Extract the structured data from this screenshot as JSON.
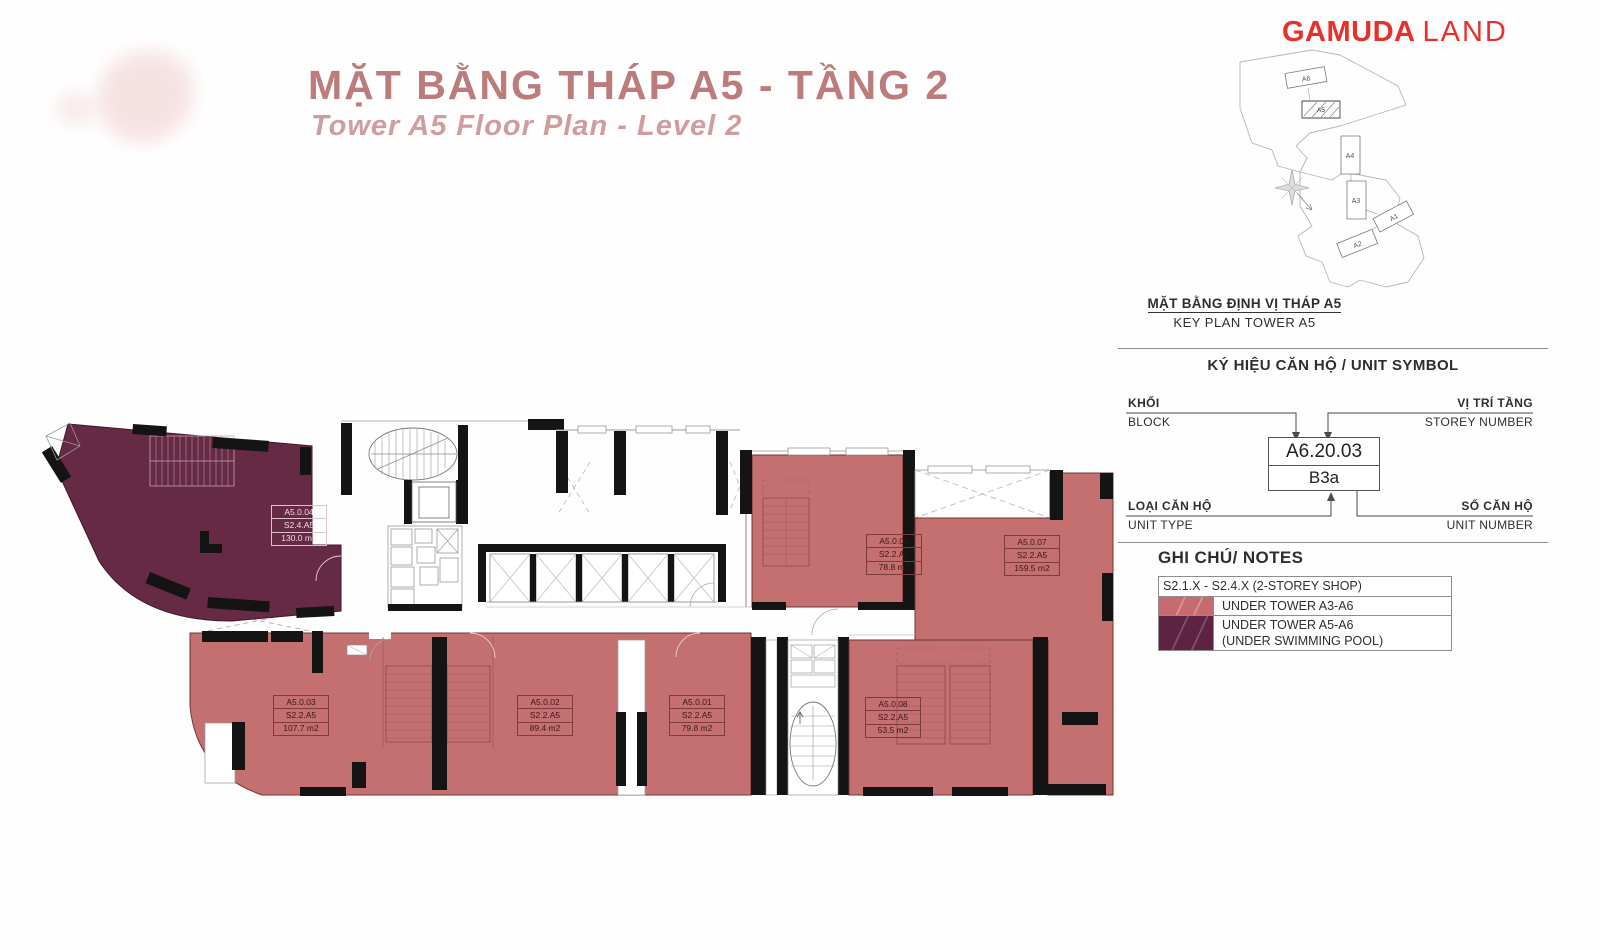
{
  "header": {
    "title_vi": "MẶT BẰNG THÁP A5 - TẦNG 2",
    "title_en": "Tower A5 Floor Plan - Level 2"
  },
  "logo": {
    "brand_bold": "GAMUDA",
    "brand_light": "LAND"
  },
  "keyplan": {
    "title_vi": "MẶT BẰNG ĐỊNH VỊ THÁP A5",
    "title_en": "KEY PLAN TOWER A5",
    "buildings": [
      "A6",
      "A5",
      "A4",
      "A3",
      "A1",
      "A2"
    ]
  },
  "unit_symbol": {
    "section_title": "KÝ HIỆU CĂN HỘ / UNIT SYMBOL",
    "block_vi": "KHỐI",
    "block_en": "BLOCK",
    "storey_vi": "VỊ TRÍ TẦNG",
    "storey_en": "STOREY NUMBER",
    "unit_type_vi": "LOẠI CĂN HỘ",
    "unit_type_en": "UNIT TYPE",
    "unit_number_vi": "SỐ CĂN HỘ",
    "unit_number_en": "UNIT NUMBER",
    "sample_code": "A6.20.03",
    "sample_type": "B3a"
  },
  "notes": {
    "title": "GHI CHÚ/ NOTES",
    "header_row": "S2.1.X - S2.4.X (2-STOREY SHOP)",
    "row_a3a6": "UNDER TOWER A3-A6",
    "row_a5a6_line1": "UNDER TOWER A5-A6",
    "row_a5a6_line2": "(UNDER SWIMMING POOL)"
  },
  "units": {
    "u04": {
      "id": "A5.0.04",
      "type": "S2.4.A5",
      "area": "130.0 m2"
    },
    "u03": {
      "id": "A5.0.03",
      "type": "S2.2.A5",
      "area": "107.7 m2"
    },
    "u02": {
      "id": "A5.0.02",
      "type": "S2.2.A5",
      "area": "89.4 m2"
    },
    "u01": {
      "id": "A5.0.01",
      "type": "S2.2.A5",
      "area": "79.8 m2"
    },
    "u08": {
      "id": "A5.0.08",
      "type": "S2.2.A5",
      "area": "53.5 m2"
    },
    "u06": {
      "id": "A5.0.06",
      "type": "S2.2.A5",
      "area": "78.8 m2"
    },
    "u07": {
      "id": "A5.0.07",
      "type": "S2.2.A5",
      "area": "159.5 m2"
    }
  },
  "colors": {
    "shop_under_a3a6": "#c66b70",
    "shop_under_pool": "#5e2342",
    "title_accent": "#bc7c7c",
    "logo_red": "#e6302a"
  }
}
